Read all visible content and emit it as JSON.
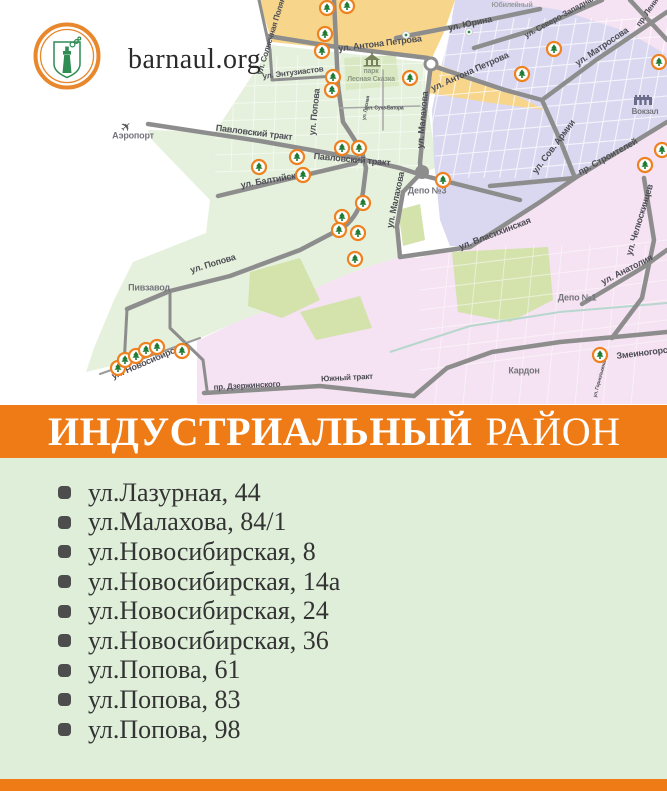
{
  "logo": {
    "site": "barnaul.org"
  },
  "banner": {
    "district": "ИНДУСТРИАЛЬНЫЙ",
    "suffix": "РАЙОН"
  },
  "addresses": [
    "ул.Лазурная, 44",
    "ул.Малахова, 84/1",
    "ул.Новосибирская, 8",
    "ул.Новосибирская, 14а",
    "ул.Новосибирская, 24",
    "ул.Новосибирская, 36",
    "ул.Попова, 61",
    "ул.Попова, 83",
    "ул.Попова, 98"
  ],
  "map": {
    "streets": [
      {
        "t": "ул. Солнечная Поляна",
        "x": 272,
        "y": 34,
        "r": -73,
        "s": 8
      },
      {
        "t": "ул. Антона Петрова",
        "x": 380,
        "y": 44,
        "r": -7,
        "s": 9
      },
      {
        "t": "ул. Антона Петрова",
        "x": 470,
        "y": 72,
        "r": -24,
        "s": 9
      },
      {
        "t": "ул. Юрина",
        "x": 470,
        "y": 24,
        "r": -12,
        "s": 9
      },
      {
        "t": "ул. Северо-Западная",
        "x": 560,
        "y": 17,
        "r": -29,
        "s": 8
      },
      {
        "t": "ул. Матросова",
        "x": 602,
        "y": 47,
        "r": -34,
        "s": 9
      },
      {
        "t": "пр. Ленина",
        "x": 650,
        "y": 9,
        "r": -55,
        "s": 8
      },
      {
        "t": "ул. Энтузиастов",
        "x": 293,
        "y": 73,
        "r": -7,
        "s": 8
      },
      {
        "t": "ул. Попова",
        "x": 315,
        "y": 112,
        "r": -84,
        "s": 9
      },
      {
        "t": "ул. Попова",
        "x": 213,
        "y": 264,
        "r": -17,
        "s": 9
      },
      {
        "t": "Павловский тракт",
        "x": 254,
        "y": 133,
        "r": 7,
        "s": 9
      },
      {
        "t": "Павловский тракт",
        "x": 352,
        "y": 160,
        "r": 5,
        "s": 9
      },
      {
        "t": "ул. Балтийская",
        "x": 273,
        "y": 180,
        "r": -10,
        "s": 9
      },
      {
        "t": "ул. Малахова",
        "x": 423,
        "y": 120,
        "r": -85,
        "s": 9
      },
      {
        "t": "ул. Малахова",
        "x": 396,
        "y": 200,
        "r": -78,
        "s": 9
      },
      {
        "t": "ул. Власихинская",
        "x": 495,
        "y": 234,
        "r": -21,
        "s": 9
      },
      {
        "t": "ул. Сов. Армии",
        "x": 554,
        "y": 147,
        "r": -53,
        "s": 9
      },
      {
        "t": "пр. Строителей",
        "x": 608,
        "y": 157,
        "r": -29,
        "s": 9
      },
      {
        "t": "ул. Челюскинцев",
        "x": 640,
        "y": 220,
        "r": -73,
        "s": 9
      },
      {
        "t": "ул. Анатолия",
        "x": 627,
        "y": 270,
        "r": -27,
        "s": 9
      },
      {
        "t": "ул. Новосибирская",
        "x": 150,
        "y": 361,
        "r": -23,
        "s": 9
      },
      {
        "t": "пр. Дзержинского",
        "x": 247,
        "y": 386,
        "r": -3,
        "s": 8
      },
      {
        "t": "Южный тракт",
        "x": 347,
        "y": 378,
        "r": -3,
        "s": 8
      },
      {
        "t": "Змеиногорский тракт",
        "x": 662,
        "y": 351,
        "r": -7,
        "s": 9
      },
      {
        "t": "ул. Сухэ-Батора",
        "x": 385,
        "y": 108,
        "r": 0,
        "s": 5
      },
      {
        "t": "ул. Лесная",
        "x": 366,
        "y": 108,
        "r": -80,
        "s": 5
      },
      {
        "t": "ул. Горнолыжная",
        "x": 600,
        "y": 378,
        "r": -75,
        "s": 5
      }
    ],
    "pois": [
      {
        "t": "Аэропорт",
        "x": 133,
        "y": 136,
        "s": 9
      },
      {
        "t": "Пивзавод",
        "x": 149,
        "y": 288,
        "s": 9
      },
      {
        "t": "Депо №3",
        "x": 427,
        "y": 191,
        "s": 9
      },
      {
        "t": "Депо №1",
        "x": 577,
        "y": 298,
        "s": 9
      },
      {
        "t": "Кардон",
        "x": 524,
        "y": 371,
        "s": 9
      },
      {
        "t": "Вокзал",
        "x": 645,
        "y": 112,
        "s": 8
      },
      {
        "t": "парк",
        "x": 371,
        "y": 71,
        "s": 7,
        "c": "park"
      },
      {
        "t": "Лесная Сказка",
        "x": 371,
        "y": 79,
        "s": 7,
        "c": "park"
      },
      {
        "t": "Юбилейный",
        "x": 512,
        "y": 5,
        "s": 7,
        "c": "light"
      }
    ],
    "markers": [
      [
        327,
        8
      ],
      [
        347,
        6
      ],
      [
        325,
        34
      ],
      [
        322,
        51
      ],
      [
        333,
        77
      ],
      [
        332,
        90
      ],
      [
        410,
        78
      ],
      [
        554,
        49
      ],
      [
        522,
        74
      ],
      [
        659,
        62
      ],
      [
        662,
        150
      ],
      [
        645,
        165
      ],
      [
        342,
        148
      ],
      [
        359,
        148
      ],
      [
        297,
        157
      ],
      [
        259,
        167
      ],
      [
        303,
        175
      ],
      [
        363,
        203
      ],
      [
        342,
        217
      ],
      [
        339,
        230
      ],
      [
        358,
        233
      ],
      [
        355,
        259
      ],
      [
        443,
        180
      ],
      [
        600,
        355
      ],
      [
        118,
        368
      ],
      [
        125,
        360
      ],
      [
        136,
        356
      ],
      [
        146,
        350
      ],
      [
        157,
        347
      ],
      [
        182,
        351
      ]
    ],
    "colors": {
      "zone_orange": "#F7D68C",
      "zone_green": "#E5F1DC",
      "zone_lavender": "#DAD8F0",
      "zone_pink": "#F5E2F2",
      "zone_olive": "#D4E2AC",
      "zone_park": "#D9E8C3",
      "road": "#8D8D8D",
      "road_minor": "#A8A8A8",
      "tram": "#B7D7CE",
      "marker_ring": "#EE8120",
      "marker_tree": "#1C7A33",
      "accent": "#EF7B16",
      "list_bg": "#DFEED9"
    }
  }
}
